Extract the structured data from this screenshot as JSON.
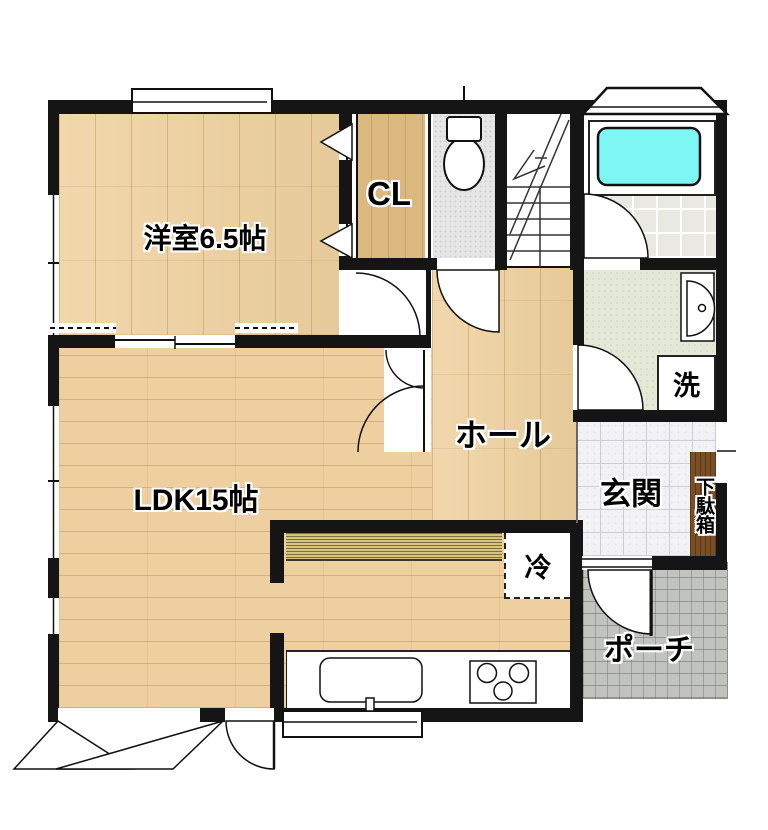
{
  "plan": {
    "title": "1F floor plan",
    "rooms": {
      "western_room": {
        "label": "洋室6.5帖"
      },
      "closet": {
        "label": "CL"
      },
      "hall": {
        "label": "ホール"
      },
      "ldk": {
        "label": "LDK15帖"
      },
      "entrance": {
        "label": "玄関"
      },
      "shoe_cabinet": {
        "label": "下駄箱"
      },
      "laundry": {
        "label": "洗"
      },
      "refrigerator": {
        "label": "冷"
      },
      "porch": {
        "label": "ポーチ"
      }
    },
    "colors": {
      "wall": "#151515",
      "wood_floor": "#EFD2A0",
      "closet_floor": "#DBB97E",
      "bathtub_fill": "#7EF6F4",
      "washroom_floor": "#E3E9D6",
      "toilet_floor": "#E6E6E6",
      "entrance_tile": "#F2F2F5",
      "porch_tile": "#C0C3BE",
      "cabinet_wood": "#7A4E25",
      "counter_stripe": "#D9C47E"
    }
  }
}
